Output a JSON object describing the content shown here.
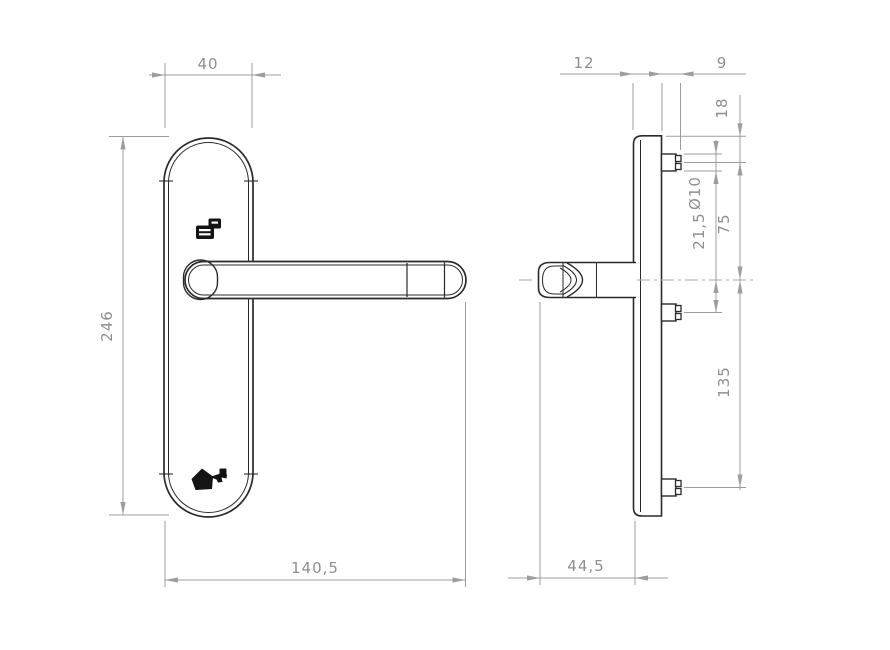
{
  "drawing": {
    "title": "Door handle with backplate - technical drawing",
    "views": {
      "front_view_name": "front view",
      "side_view_name": "side view"
    },
    "colors": {
      "background": "#ffffff",
      "part_line": "#2a2a2a",
      "dimension_line": "#9d9d9d",
      "dimension_text": "#8f8f8f",
      "icon_fill": "#141414"
    },
    "icons": {
      "top_icon": "cylinder-lock-icon",
      "bottom_icon": "key-icon"
    },
    "front_view": {
      "plate_width": "40",
      "plate_height": "246",
      "overall_width": "140,5"
    },
    "side_view": {
      "plate_thickness": "12",
      "peg_length": "9",
      "plate_top_to_peg": "18",
      "peg_diameter": "Ø10",
      "center_to_mid_peg": "21,5",
      "top_peg_to_center": "75",
      "center_to_bottom_peg": "135",
      "overall_depth": "44,5"
    }
  }
}
